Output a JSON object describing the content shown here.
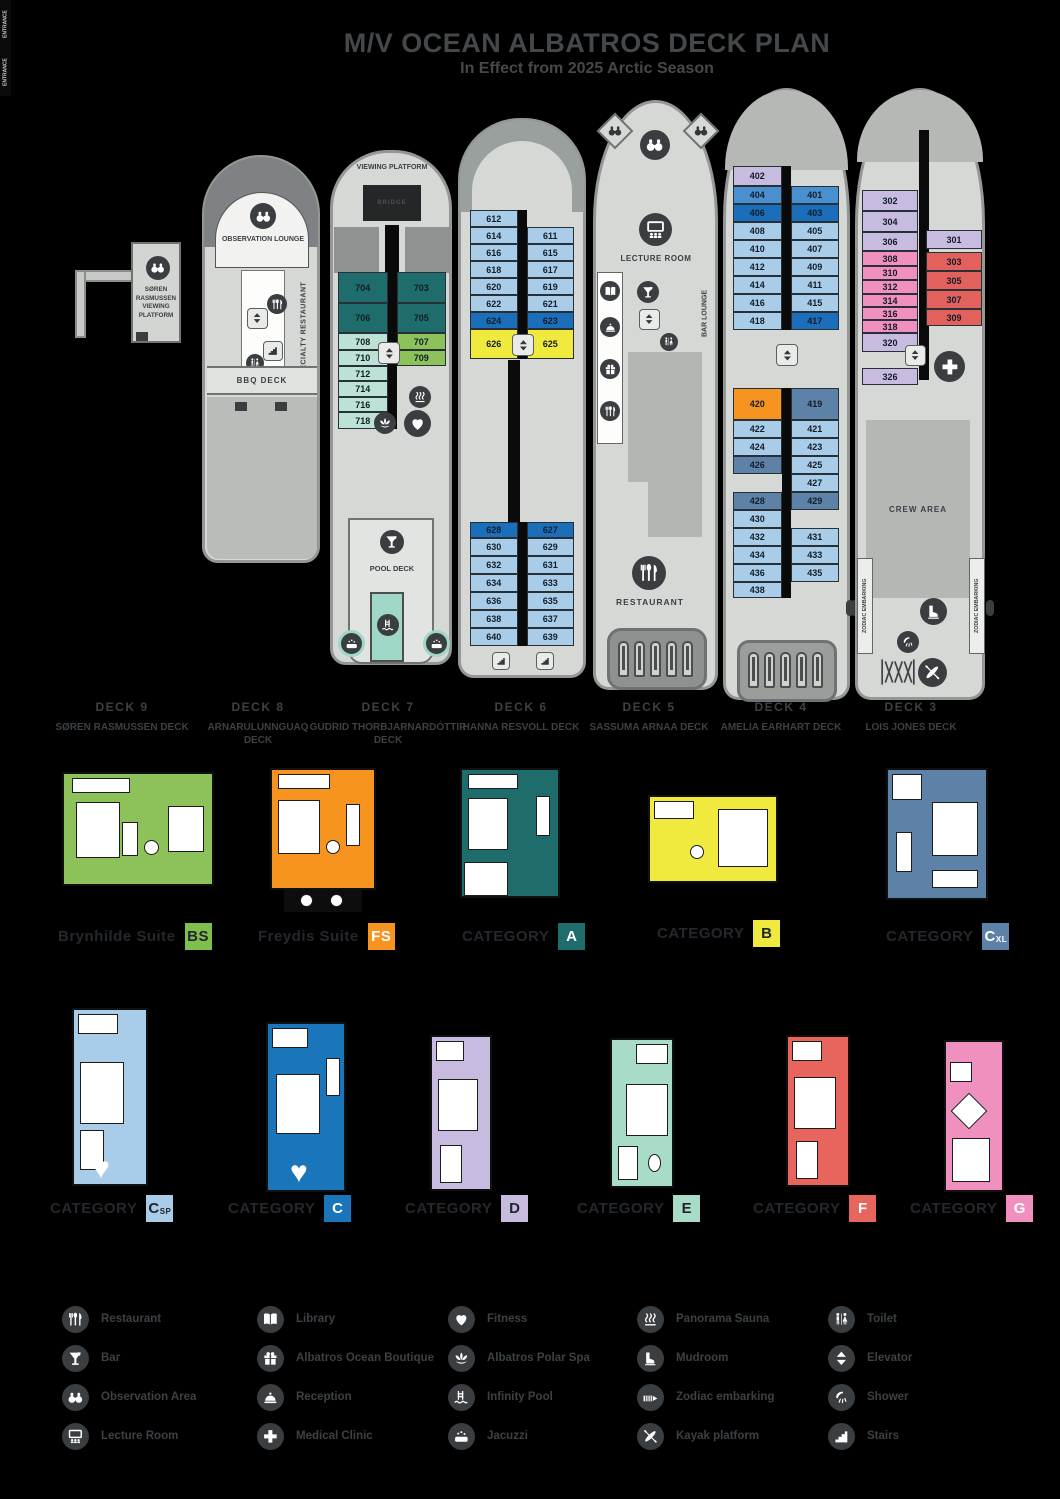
{
  "title": "M/V OCEAN ALBATROS DECK PLAN",
  "subtitle": "In Effect from 2025 Arctic Season",
  "colors": {
    "teal": "#1E6C6B",
    "mint": "#BCE2D5",
    "green": "#8DC159",
    "light_blue": "#A9CDE9",
    "medium_blue": "#4A90D0",
    "dark_blue": "#1B6FBA",
    "yellow": "#F1EA3E",
    "orange": "#F79420",
    "lavender": "#C7BCE0",
    "steel_blue": "#5E81A8",
    "pink": "#F090BE",
    "red": "#E2615C",
    "hull": "#D6D8D5",
    "icon_bg": "#3A3E41",
    "text": "#3C4145"
  },
  "decks": {
    "deck9": {
      "name": "DECK 9",
      "subname": "SØREN RASMUSSEN DECK",
      "platform_label": "SØREN RASMUSSEN VIEWING PLATFORM"
    },
    "deck8": {
      "name": "DECK 8",
      "subname": "ARNARULUNNGUAQ DECK",
      "observation_label": "OBSERVATION LOUNGE",
      "specialty_label": "SPECIALTY RESTAURANT",
      "bbq_label": "BBQ DECK"
    },
    "deck7": {
      "name": "DECK 7",
      "subname": "GUDRID THORBJARNARDÓTTIR DECK",
      "viewing_label": "VIEWING PLATFORM",
      "bridge_label": "BRIDGE",
      "pool_label": "POOL DECK",
      "rows": [
        {
          "h": 31,
          "c": [
            {
              "n": "704",
              "k": "teal"
            },
            {
              "n": "703",
              "k": "teal"
            }
          ]
        },
        {
          "h": 30,
          "c": [
            {
              "n": "706",
              "k": "teal"
            },
            {
              "n": "705",
              "k": "teal"
            }
          ]
        },
        {
          "h": 17,
          "c": [
            {
              "n": "708",
              "k": "mint"
            },
            {
              "n": "707",
              "k": "green"
            }
          ]
        },
        {
          "h": 16,
          "c": [
            {
              "n": "710",
              "k": "mint"
            },
            {
              "n": "709",
              "k": "green"
            }
          ]
        },
        {
          "h": 15,
          "c": [
            {
              "n": "712",
              "k": "mint"
            },
            {
              "n": "",
              "k": "none"
            }
          ]
        },
        {
          "h": 16,
          "c": [
            {
              "n": "714",
              "k": "mint"
            },
            {
              "n": "",
              "k": "none"
            }
          ]
        },
        {
          "h": 15,
          "c": [
            {
              "n": "716",
              "k": "mint"
            },
            {
              "n": "",
              "k": "none"
            }
          ]
        },
        {
          "h": 17,
          "c": [
            {
              "n": "718",
              "k": "mint"
            },
            {
              "n": "",
              "k": "none"
            }
          ]
        }
      ]
    },
    "deck6": {
      "name": "DECK 6",
      "subname": "HANNA RESVOLL DECK",
      "top_rows": [
        {
          "h": 17,
          "c": [
            {
              "n": "612",
              "k": "blue"
            },
            {
              "n": "",
              "k": "none"
            }
          ]
        },
        {
          "h": 17,
          "c": [
            {
              "n": "614",
              "k": "blue"
            },
            {
              "n": "611",
              "k": "blue"
            }
          ]
        },
        {
          "h": 17,
          "c": [
            {
              "n": "616",
              "k": "blue"
            },
            {
              "n": "615",
              "k": "blue"
            }
          ]
        },
        {
          "h": 17,
          "c": [
            {
              "n": "618",
              "k": "blue"
            },
            {
              "n": "617",
              "k": "blue"
            }
          ]
        },
        {
          "h": 17,
          "c": [
            {
              "n": "620",
              "k": "blue"
            },
            {
              "n": "619",
              "k": "blue"
            }
          ]
        },
        {
          "h": 17,
          "c": [
            {
              "n": "622",
              "k": "blue"
            },
            {
              "n": "621",
              "k": "blue"
            }
          ]
        },
        {
          "h": 17,
          "c": [
            {
              "n": "624",
              "k": "dblue"
            },
            {
              "n": "623",
              "k": "dblue"
            }
          ]
        },
        {
          "h": 30,
          "c": [
            {
              "n": "626",
              "k": "yellow"
            },
            {
              "n": "625",
              "k": "yellow"
            }
          ]
        }
      ],
      "bottom_rows": [
        {
          "h": 16,
          "c": [
            {
              "n": "628",
              "k": "dblue"
            },
            {
              "n": "627",
              "k": "dblue"
            }
          ]
        },
        {
          "h": 18,
          "c": [
            {
              "n": "630",
              "k": "blue"
            },
            {
              "n": "629",
              "k": "blue"
            }
          ]
        },
        {
          "h": 18,
          "c": [
            {
              "n": "632",
              "k": "blue"
            },
            {
              "n": "631",
              "k": "blue"
            }
          ]
        },
        {
          "h": 18,
          "c": [
            {
              "n": "634",
              "k": "blue"
            },
            {
              "n": "633",
              "k": "blue"
            }
          ]
        },
        {
          "h": 18,
          "c": [
            {
              "n": "636",
              "k": "blue"
            },
            {
              "n": "635",
              "k": "blue"
            }
          ]
        },
        {
          "h": 18,
          "c": [
            {
              "n": "638",
              "k": "blue"
            },
            {
              "n": "637",
              "k": "blue"
            }
          ]
        },
        {
          "h": 18,
          "c": [
            {
              "n": "640",
              "k": "blue"
            },
            {
              "n": "639",
              "k": "blue"
            }
          ]
        }
      ]
    },
    "deck5": {
      "name": "DECK 5",
      "subname": "SASSUMA ARNAA DECK",
      "lecture_label": "LECTURE ROOM",
      "bar_label": "BAR LOUNGE",
      "restaurant_label": "RESTAURANT"
    },
    "deck4": {
      "name": "DECK 4",
      "subname": "AMELIA EARHART DECK",
      "entrance_label": "ENTRANCE",
      "top_rows": [
        {
          "h": 20,
          "c": [
            {
              "n": "402",
              "k": "lav"
            },
            {
              "n": "",
              "k": "none"
            }
          ]
        },
        {
          "h": 18,
          "c": [
            {
              "n": "404",
              "k": "mblue"
            },
            {
              "n": "401",
              "k": "mblue"
            }
          ]
        },
        {
          "h": 18,
          "c": [
            {
              "n": "406",
              "k": "dblue"
            },
            {
              "n": "403",
              "k": "dblue"
            }
          ]
        },
        {
          "h": 18,
          "c": [
            {
              "n": "408",
              "k": "blue"
            },
            {
              "n": "405",
              "k": "blue"
            }
          ]
        },
        {
          "h": 18,
          "c": [
            {
              "n": "410",
              "k": "blue"
            },
            {
              "n": "407",
              "k": "blue"
            }
          ]
        },
        {
          "h": 18,
          "c": [
            {
              "n": "412",
              "k": "blue"
            },
            {
              "n": "409",
              "k": "blue"
            }
          ]
        },
        {
          "h": 18,
          "c": [
            {
              "n": "414",
              "k": "blue"
            },
            {
              "n": "411",
              "k": "blue"
            }
          ]
        },
        {
          "h": 18,
          "c": [
            {
              "n": "416",
              "k": "blue"
            },
            {
              "n": "415",
              "k": "blue"
            }
          ]
        },
        {
          "h": 18,
          "c": [
            {
              "n": "418",
              "k": "blue"
            },
            {
              "n": "417",
              "k": "dblue"
            }
          ]
        }
      ],
      "mid_rows": [
        {
          "h": 32,
          "c": [
            {
              "n": "420",
              "k": "orange"
            },
            {
              "n": "419",
              "k": "steel"
            }
          ]
        },
        {
          "h": 18,
          "c": [
            {
              "n": "422",
              "k": "blue"
            },
            {
              "n": "421",
              "k": "blue"
            }
          ]
        },
        {
          "h": 18,
          "c": [
            {
              "n": "424",
              "k": "blue"
            },
            {
              "n": "423",
              "k": "blue"
            }
          ]
        },
        {
          "h": 18,
          "c": [
            {
              "n": "426",
              "k": "steel"
            },
            {
              "n": "425",
              "k": "blue"
            }
          ]
        },
        {
          "h": 18,
          "c": [
            {
              "n": "",
              "k": "none"
            },
            {
              "n": "427",
              "k": "blue"
            }
          ]
        },
        {
          "h": 18,
          "c": [
            {
              "n": "428",
              "k": "steel"
            },
            {
              "n": "429",
              "k": "steel"
            }
          ]
        },
        {
          "h": 18,
          "c": [
            {
              "n": "430",
              "k": "blue"
            },
            {
              "n": "",
              "k": "none"
            }
          ]
        },
        {
          "h": 18,
          "c": [
            {
              "n": "432",
              "k": "blue"
            },
            {
              "n": "431",
              "k": "blue"
            }
          ]
        },
        {
          "h": 18,
          "c": [
            {
              "n": "434",
              "k": "blue"
            },
            {
              "n": "433",
              "k": "blue"
            }
          ]
        },
        {
          "h": 18,
          "c": [
            {
              "n": "436",
              "k": "blue"
            },
            {
              "n": "435",
              "k": "blue"
            }
          ]
        },
        {
          "h": 16,
          "c": [
            {
              "n": "438",
              "k": "blue"
            },
            {
              "n": "",
              "k": "none"
            }
          ]
        }
      ]
    },
    "deck3": {
      "name": "DECK 3",
      "subname": "LOIS JONES DECK",
      "crew_label": "CREW AREA",
      "zodiac_label": "ZODIAC EMBARKING",
      "left_col": [
        {
          "n": "302",
          "k": "lav",
          "h": 21
        },
        {
          "n": "304",
          "k": "lav",
          "h": 21
        },
        {
          "n": "306",
          "k": "lav",
          "h": 19
        },
        {
          "n": "308",
          "k": "pink",
          "h": 15
        },
        {
          "n": "310",
          "k": "pink",
          "h": 14
        },
        {
          "n": "312",
          "k": "pink",
          "h": 14
        },
        {
          "n": "314",
          "k": "pink",
          "h": 13
        },
        {
          "n": "316",
          "k": "pink",
          "h": 13
        },
        {
          "n": "318",
          "k": "pink",
          "h": 13
        },
        {
          "n": "320",
          "k": "lav",
          "h": 19
        },
        {
          "g": 16
        },
        {
          "n": "326",
          "k": "lav",
          "h": 17
        }
      ],
      "right_col": [
        {
          "g": 40
        },
        {
          "n": "301",
          "k": "lav",
          "h": 19
        },
        {
          "g": 3
        },
        {
          "n": "303",
          "k": "red",
          "h": 19
        },
        {
          "n": "305",
          "k": "red",
          "h": 19
        },
        {
          "n": "307",
          "k": "red",
          "h": 19
        },
        {
          "n": "309",
          "k": "red",
          "h": 17
        }
      ]
    }
  },
  "categories": {
    "row1": [
      {
        "label": "Brynhilde Suite",
        "badge": "BS",
        "color": "#7FBF4D"
      },
      {
        "label": "Freydis Suite",
        "badge": "FS",
        "color": "#F79420"
      },
      {
        "label": "CATEGORY",
        "badge": "A",
        "color": "#1E6C6B"
      },
      {
        "label": "CATEGORY",
        "badge": "B",
        "color": "#F1EA3E"
      },
      {
        "label": "CATEGORY",
        "badge": "C",
        "sub": "XL",
        "color": "#5E81A8"
      }
    ],
    "row2": [
      {
        "label": "CATEGORY",
        "badge": "C",
        "sub": "SP",
        "color": "#A9CDE9"
      },
      {
        "label": "CATEGORY",
        "badge": "C",
        "color": "#1B75BB"
      },
      {
        "label": "CATEGORY",
        "badge": "D",
        "color": "#C7BCE0"
      },
      {
        "label": "CATEGORY",
        "badge": "E",
        "color": "#A9DCC6"
      },
      {
        "label": "CATEGORY",
        "badge": "F",
        "color": "#E8655E"
      },
      {
        "label": "CATEGORY",
        "badge": "G",
        "color": "#F090BE"
      }
    ]
  },
  "legend": {
    "columns": [
      [
        {
          "icon": "restaurant",
          "label": "Restaurant"
        },
        {
          "icon": "bar",
          "label": "Bar"
        },
        {
          "icon": "observation",
          "label": "Observation Area"
        },
        {
          "icon": "lecture",
          "label": "Lecture Room"
        }
      ],
      [
        {
          "icon": "library",
          "label": "Library"
        },
        {
          "icon": "boutique",
          "label": "Albatros Ocean Boutique"
        },
        {
          "icon": "reception",
          "label": "Reception"
        },
        {
          "icon": "medical",
          "label": "Medical Clinic"
        }
      ],
      [
        {
          "icon": "fitness",
          "label": "Fitness"
        },
        {
          "icon": "spa",
          "label": "Albatros Polar Spa"
        },
        {
          "icon": "pool",
          "label": "Infinity Pool"
        },
        {
          "icon": "jacuzzi",
          "label": "Jacuzzi"
        }
      ],
      [
        {
          "icon": "sauna",
          "label": "Panorama Sauna"
        },
        {
          "icon": "mudroom",
          "label": "Mudroom"
        },
        {
          "icon": "zodiac",
          "label": "Zodiac embarking"
        },
        {
          "icon": "kayak",
          "label": "Kayak platform"
        }
      ],
      [
        {
          "icon": "toilet",
          "label": "Toilet"
        },
        {
          "icon": "elevator",
          "label": "Elevator"
        },
        {
          "icon": "shower",
          "label": "Shower"
        },
        {
          "icon": "stairs",
          "label": "Stairs"
        }
      ]
    ]
  }
}
